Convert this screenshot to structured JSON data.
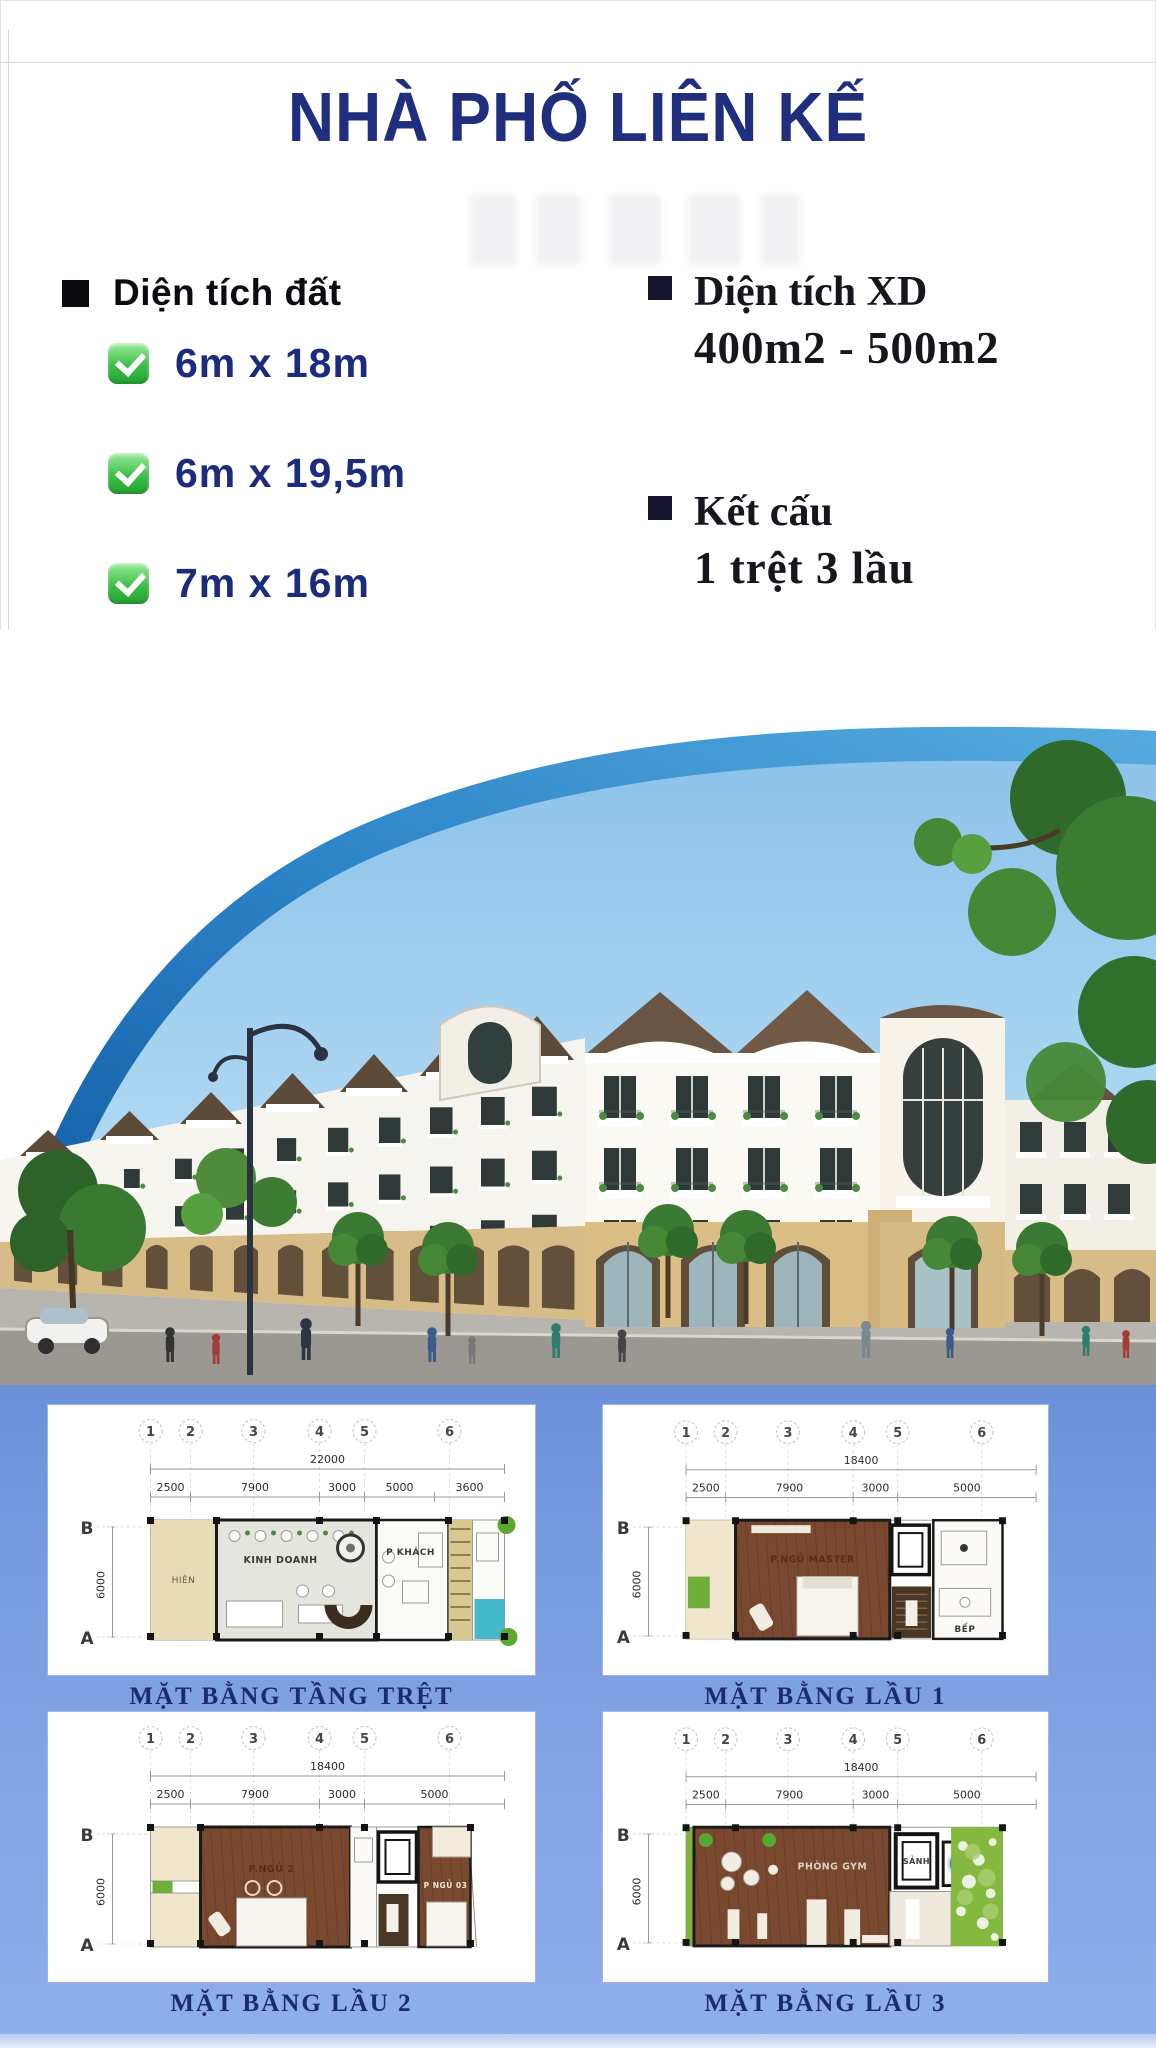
{
  "page": {
    "title": "NHÀ PHỐ LIÊN KẾ"
  },
  "colors": {
    "title_navy": "#202e7e",
    "item_navy": "#1c2b7e",
    "check_green": "#3cbf47",
    "band_blue": "#1a6db4",
    "sky_blue": "#9ccdec",
    "plans_background_blue": "#7a9de1",
    "plan_title_navy": "#1c2a6e",
    "arcade_tan": "#d7bc87",
    "pool_teal": "#45b8cc",
    "floor_brown": "#7a4a33",
    "garden_green": "#85b83e"
  },
  "land": {
    "heading": "Diện tích đất",
    "items": [
      "6m x 18m",
      "6m x 19,5m",
      "7m x 16m"
    ]
  },
  "specs": {
    "items": [
      {
        "heading": "Diện tích XD",
        "value": "400m2 - 500m2"
      },
      {
        "heading": "Kết cấu",
        "value": "1 trệt 3 lầu"
      }
    ]
  },
  "floor_plans": {
    "grid_columns": [
      "1",
      "2",
      "3",
      "4",
      "5",
      "6"
    ],
    "row_labels": [
      "B",
      "A"
    ],
    "side_dimension": "6000",
    "panels": [
      {
        "title": "MẶT BẰNG TẦNG TRỆT",
        "total_dimension": "22000",
        "segment_dimensions": [
          "2500",
          "7900",
          "3000",
          "5000",
          "3600"
        ],
        "rooms": [
          "HIÊN",
          "KINH DOANH",
          "P KHÁCH"
        ]
      },
      {
        "title": "MẶT BẰNG LẦU 1",
        "total_dimension": "18400",
        "segment_dimensions": [
          "2500",
          "7900",
          "3000",
          "5000"
        ],
        "rooms": [
          "P.NGỦ MASTER",
          "BẾP"
        ]
      },
      {
        "title": "MẶT BẰNG LẦU 2",
        "total_dimension": "18400",
        "segment_dimensions": [
          "2500",
          "7900",
          "3000",
          "5000"
        ],
        "rooms": [
          "P.NGỦ 2",
          "P NGỦ 03"
        ]
      },
      {
        "title": "MẶT BẰNG LẦU 3",
        "total_dimension": "18400",
        "segment_dimensions": [
          "2500",
          "7900",
          "3000",
          "5000"
        ],
        "rooms": [
          "PHÒNG GYM",
          "SẢNH"
        ]
      }
    ]
  }
}
